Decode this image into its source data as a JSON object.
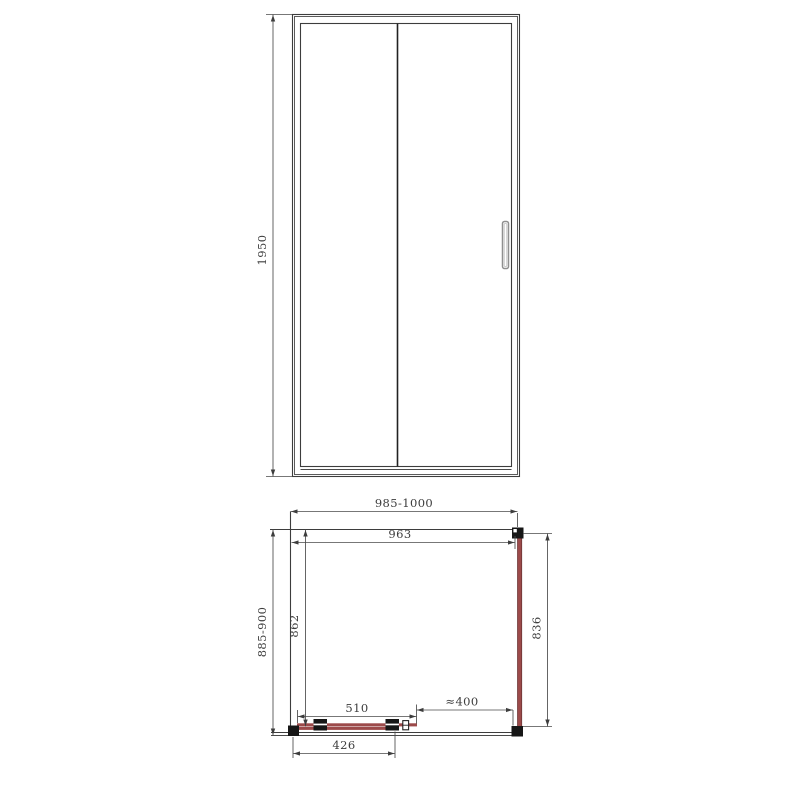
{
  "drawing": {
    "type": "shower enclosure technical drawing (front elevation + plan view)",
    "front_view": {
      "height_dim": "1950"
    },
    "plan_view": {
      "overall_width_dim": "985-1000",
      "glass_width_dim": "963",
      "overall_depth_dim": "885-900",
      "inner_depth_dim": "862",
      "side_panel_dim": "836",
      "slide_dim": "510",
      "opening_dim": "≈400",
      "panel_width_dim": "426"
    },
    "colors": {
      "line": "#3d3d3d",
      "glass_highlight": "#9c4a4a",
      "background": "#ffffff"
    }
  }
}
